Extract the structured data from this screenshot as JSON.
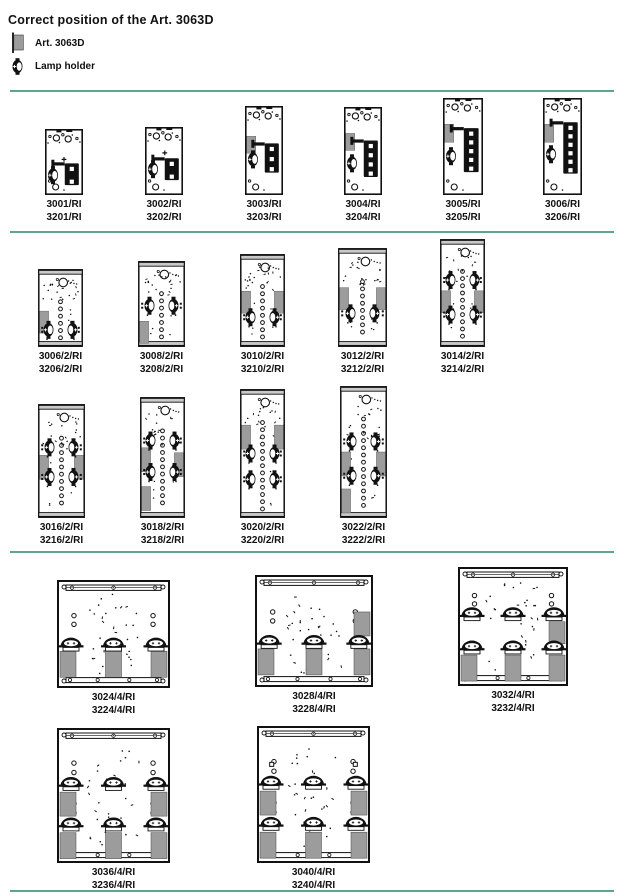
{
  "title": "Correct position of the Art. 3063D",
  "legend": {
    "art_label": "Art. 3063D",
    "lamp_label": "Lamp holder"
  },
  "colors": {
    "teal": "#5fa491",
    "art_gray": "#9c9c9c",
    "bar_gray": "#c9c9c9",
    "ink": "#111111"
  },
  "separators": [
    {
      "y": 90
    },
    {
      "y": 231
    },
    {
      "y": 551
    },
    {
      "y": 890
    }
  ],
  "figures": [
    {
      "id": "3001-ri",
      "labels": [
        "3001/RI",
        "3201/RI"
      ],
      "kind": "unit",
      "x": 45,
      "w": 38,
      "h": 66,
      "bottom": 195,
      "seed": 11,
      "unit": {
        "blockRows": 2,
        "blockTop": 0.52,
        "lampY": 0.7,
        "gray": null,
        "cross": [
          0.5,
          0.46
        ]
      }
    },
    {
      "id": "3002-ri",
      "labels": [
        "3002/RI",
        "3202/RI"
      ],
      "kind": "unit",
      "x": 145,
      "w": 38,
      "h": 68,
      "bottom": 195,
      "seed": 12,
      "unit": {
        "blockRows": 2,
        "blockTop": 0.46,
        "lampY": 0.62,
        "gray": null,
        "cross": [
          0.52,
          0.38
        ]
      }
    },
    {
      "id": "3003-ri",
      "labels": [
        "3003/RI",
        "3203/RI"
      ],
      "kind": "unit",
      "x": 245,
      "w": 38,
      "h": 89,
      "bottom": 195,
      "seed": 13,
      "unit": {
        "blockRows": 3,
        "blockTop": 0.42,
        "lampY": 0.6,
        "gray": {
          "y": 0.34,
          "h": 17
        },
        "cross": null
      }
    },
    {
      "id": "3004-ri",
      "labels": [
        "3004/RI",
        "3204/RI"
      ],
      "kind": "unit",
      "x": 344,
      "w": 38,
      "h": 88,
      "bottom": 195,
      "seed": 14,
      "unit": {
        "blockRows": 4,
        "blockTop": 0.38,
        "lampY": 0.64,
        "gray": {
          "y": 0.3,
          "h": 17
        },
        "cross": null
      }
    },
    {
      "id": "3005-ri",
      "labels": [
        "3005/RI",
        "3205/RI"
      ],
      "kind": "unit",
      "x": 443,
      "w": 40,
      "h": 97,
      "bottom": 195,
      "seed": 15,
      "unit": {
        "blockRows": 5,
        "blockTop": 0.31,
        "lampY": 0.6,
        "gray": {
          "y": 0.27,
          "h": 18
        },
        "cross": null
      }
    },
    {
      "id": "3006-ri",
      "labels": [
        "3006/RI",
        "3206/RI"
      ],
      "kind": "unit",
      "x": 543,
      "w": 39,
      "h": 97,
      "bottom": 195,
      "seed": 16,
      "unit": {
        "blockRows": 6,
        "blockTop": 0.25,
        "lampY": 0.58,
        "gray": {
          "y": 0.27,
          "h": 18
        },
        "cross": null
      }
    },
    {
      "id": "3006-2-ri",
      "labels": [
        "3006/2/RI",
        "3206/2/RI"
      ],
      "kind": "twin",
      "x": 38,
      "w": 45,
      "h": 78,
      "bottom": 347,
      "seed": 21,
      "twin": {
        "holesFrom": 0.42,
        "lampRows": [
          0.78
        ],
        "grays": [
          {
            "side": "L",
            "y": 0.54,
            "h": 22
          }
        ]
      }
    },
    {
      "id": "3008-2-ri",
      "labels": [
        "3008/2/RI",
        "3208/2/RI"
      ],
      "kind": "twin",
      "x": 138,
      "w": 47,
      "h": 86,
      "bottom": 347,
      "seed": 22,
      "twin": {
        "holesFrom": 0.38,
        "lampRows": [
          0.52
        ],
        "grays": [
          {
            "side": "L",
            "y": 0.7,
            "h": 22
          }
        ]
      }
    },
    {
      "id": "3010-2-ri",
      "labels": [
        "3010/2/RI",
        "3210/2/RI"
      ],
      "kind": "twin",
      "x": 240,
      "w": 45,
      "h": 93,
      "bottom": 347,
      "seed": 23,
      "twin": {
        "holesFrom": 0.35,
        "lampRows": [
          0.68
        ],
        "grays": [
          {
            "side": "L",
            "y": 0.4,
            "h": 22
          },
          {
            "side": "R",
            "y": 0.4,
            "h": 22
          }
        ]
      }
    },
    {
      "id": "3012-2-ri",
      "labels": [
        "3012/2/RI",
        "3212/2/RI"
      ],
      "kind": "twin",
      "x": 338,
      "w": 49,
      "h": 99,
      "bottom": 347,
      "seed": 24,
      "twin": {
        "holesFrom": 0.34,
        "lampRows": [
          0.66
        ],
        "grays": [
          {
            "side": "L",
            "y": 0.4,
            "h": 22
          },
          {
            "side": "R",
            "y": 0.4,
            "h": 22
          }
        ]
      }
    },
    {
      "id": "3014-2-ri",
      "labels": [
        "3014/2/RI",
        "3214/2/RI"
      ],
      "kind": "twin",
      "x": 440,
      "w": 45,
      "h": 108,
      "bottom": 347,
      "seed": 25,
      "twin": {
        "holesFrom": 0.3,
        "lampRows": [
          0.38,
          0.7
        ],
        "grays": [
          {
            "side": "L",
            "y": 0.48,
            "h": 22
          },
          {
            "side": "R",
            "y": 0.48,
            "h": 22
          }
        ]
      }
    },
    {
      "id": "3016-2-ri",
      "labels": [
        "3016/2/RI",
        "3216/2/RI"
      ],
      "kind": "twin",
      "x": 38,
      "w": 47,
      "h": 114,
      "bottom": 518,
      "seed": 31,
      "twin": {
        "holesFrom": 0.3,
        "lampRows": [
          0.38,
          0.64
        ],
        "grays": [
          {
            "side": "L",
            "y": 0.45,
            "h": 24
          },
          {
            "side": "R",
            "y": 0.45,
            "h": 24
          }
        ]
      }
    },
    {
      "id": "3018-2-ri",
      "labels": [
        "3018/2/RI",
        "3218/2/RI"
      ],
      "kind": "twin",
      "x": 140,
      "w": 45,
      "h": 121,
      "bottom": 518,
      "seed": 32,
      "twin": {
        "holesFrom": 0.28,
        "lampRows": [
          0.36,
          0.62
        ],
        "grays": [
          {
            "side": "L",
            "y": 0.42,
            "h": 24
          },
          {
            "side": "R",
            "y": 0.46,
            "h": 24
          },
          {
            "side": "L",
            "y": 0.74,
            "h": 24
          }
        ]
      }
    },
    {
      "id": "3020-2-ri",
      "labels": [
        "3020/2/RI",
        "3220/2/RI"
      ],
      "kind": "twin",
      "x": 240,
      "w": 45,
      "h": 129,
      "bottom": 518,
      "seed": 33,
      "twin": {
        "holesFrom": 0.26,
        "lampRows": [
          0.5,
          0.7
        ],
        "grays": [
          {
            "side": "L",
            "y": 0.28,
            "h": 24
          },
          {
            "side": "R",
            "y": 0.28,
            "h": 24
          }
        ]
      }
    },
    {
      "id": "3022-2-ri",
      "labels": [
        "3022/2/RI",
        "3222/2/RI"
      ],
      "kind": "twin",
      "x": 340,
      "w": 47,
      "h": 132,
      "bottom": 518,
      "seed": 34,
      "twin": {
        "holesFrom": 0.25,
        "lampRows": [
          0.42,
          0.68
        ],
        "grays": [
          {
            "side": "L",
            "y": 0.5,
            "h": 24
          },
          {
            "side": "R",
            "y": 0.5,
            "h": 24
          },
          {
            "side": "L",
            "y": 0.78,
            "h": 24
          }
        ]
      }
    },
    {
      "id": "3024-4-ri",
      "labels": [
        "3024/4/RI",
        "3224/4/RI"
      ],
      "kind": "quad",
      "x": 57,
      "w": 113,
      "h": 108,
      "bottom": 688,
      "seed": 41,
      "quad": {
        "lampRows": [
          {
            "y": 0.58,
            "xs": [
              0.12,
              0.5,
              0.88
            ]
          }
        ],
        "grays": [
          {
            "edge": "L",
            "y": 0.66
          },
          {
            "x": 0.5,
            "y": 0.66
          },
          {
            "edge": "R",
            "y": 0.66
          }
        ],
        "sideHoles": [
          0.33,
          0.41
        ],
        "squares": []
      }
    },
    {
      "id": "3028-4-ri",
      "labels": [
        "3028/4/RI",
        "3228/4/RI"
      ],
      "kind": "quad",
      "x": 255,
      "w": 118,
      "h": 112,
      "bottom": 687,
      "seed": 42,
      "quad": {
        "lampRows": [
          {
            "y": 0.58,
            "xs": [
              0.12,
              0.5,
              0.88
            ]
          }
        ],
        "grays": [
          {
            "edge": "L",
            "y": 0.66
          },
          {
            "x": 0.5,
            "y": 0.66
          },
          {
            "edge": "R",
            "y": 0.66
          },
          {
            "edge": "R",
            "y": 0.33,
            "h": 24
          }
        ],
        "sideHoles": [
          0.33,
          0.41
        ],
        "squares": []
      }
    },
    {
      "id": "3032-4-ri",
      "labels": [
        "3032/4/RI",
        "3232/4/RI"
      ],
      "kind": "quad",
      "x": 458,
      "w": 110,
      "h": 119,
      "bottom": 686,
      "seed": 43,
      "quad": {
        "lampRows": [
          {
            "y": 0.38,
            "xs": [
              0.12,
              0.5,
              0.88
            ]
          },
          {
            "y": 0.66,
            "xs": [
              0.12,
              0.5,
              0.88
            ]
          }
        ],
        "grays": [
          {
            "edge": "R",
            "y": 0.46,
            "h": 22
          },
          {
            "edge": "L",
            "y": 0.74
          },
          {
            "x": 0.5,
            "y": 0.74
          },
          {
            "edge": "R",
            "y": 0.74
          }
        ],
        "sideHoles": [
          0.24,
          0.31
        ],
        "squares": []
      }
    },
    {
      "id": "3036-4-ri",
      "labels": [
        "3036/4/RI",
        "3236/4/RI"
      ],
      "kind": "quad",
      "x": 57,
      "w": 113,
      "h": 135,
      "bottom": 863,
      "seed": 51,
      "quad": {
        "lampRows": [
          {
            "y": 0.4,
            "xs": [
              0.12,
              0.5,
              0.88
            ]
          },
          {
            "y": 0.7,
            "xs": [
              0.12,
              0.5,
              0.88
            ]
          }
        ],
        "grays": [
          {
            "edge": "L",
            "y": 0.475,
            "h": 24
          },
          {
            "edge": "R",
            "y": 0.475,
            "h": 24
          },
          {
            "edge": "L",
            "y": 0.775
          },
          {
            "x": 0.5,
            "y": 0.775
          },
          {
            "edge": "R",
            "y": 0.775
          }
        ],
        "sideHoles": [
          0.26,
          0.33,
          0.56,
          0.63
        ],
        "squares": []
      }
    },
    {
      "id": "3040-4-ri",
      "labels": [
        "3040/4/RI",
        "3240/4/RI"
      ],
      "kind": "quad",
      "x": 257,
      "w": 113,
      "h": 137,
      "bottom": 863,
      "seed": 52,
      "quad": {
        "lampRows": [
          {
            "y": 0.4,
            "xs": [
              0.12,
              0.5,
              0.88
            ]
          },
          {
            "y": 0.7,
            "xs": [
              0.12,
              0.5,
              0.88
            ]
          }
        ],
        "grays": [
          {
            "edge": "L",
            "y": 0.475,
            "h": 24
          },
          {
            "edge": "R",
            "y": 0.475,
            "h": 24
          },
          {
            "edge": "L",
            "y": 0.775
          },
          {
            "x": 0.5,
            "y": 0.775
          },
          {
            "edge": "R",
            "y": 0.775
          }
        ],
        "sideHoles": [
          0.26,
          0.33,
          0.56,
          0.63
        ],
        "squares": [
          [
            0.13,
            0.28
          ],
          [
            0.87,
            0.28
          ]
        ]
      }
    }
  ]
}
